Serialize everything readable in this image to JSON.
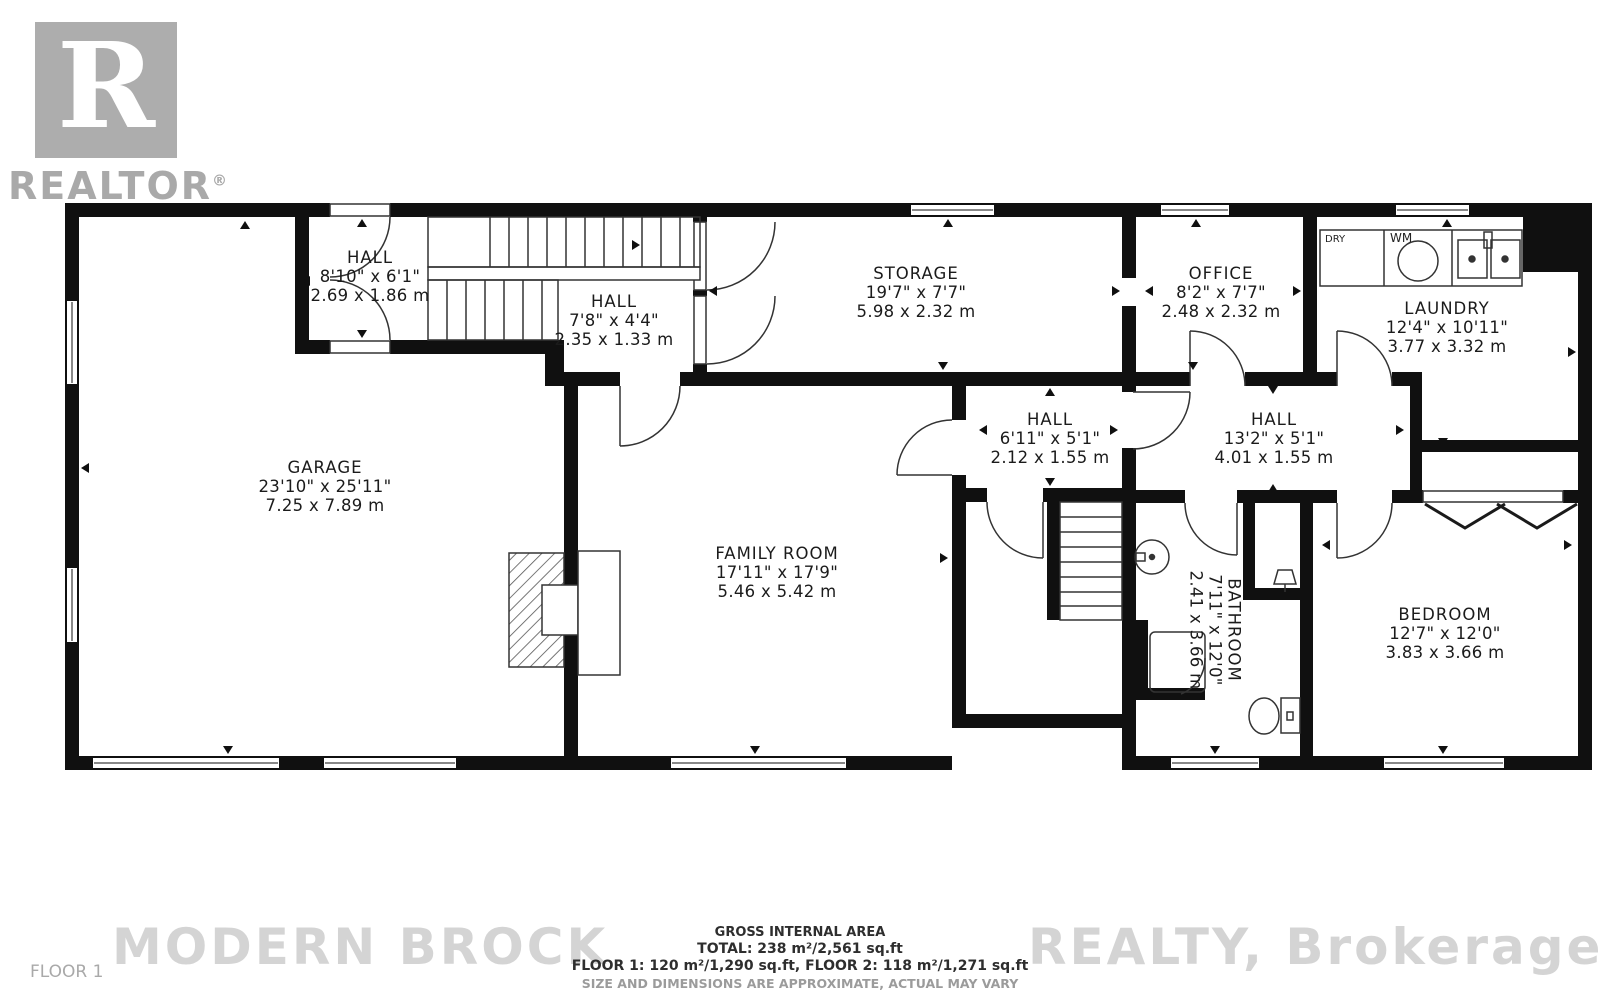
{
  "logo": {
    "letter": "R",
    "brand": "REALTOR",
    "registered": "®"
  },
  "floor_label": "FLOOR 1",
  "watermark": {
    "left": "MODERN BROCK",
    "right": "REALTY, Brokerage"
  },
  "footer": {
    "line1": "GROSS INTERNAL AREA",
    "line2": "TOTAL: 238 m²/2,561 sq.ft",
    "line3": "FLOOR 1: 120 m²/1,290 sq.ft, FLOOR 2: 118 m²/1,271 sq.ft",
    "line4": "SIZE AND DIMENSIONS ARE APPROXIMATE, ACTUAL MAY VARY"
  },
  "appliances": {
    "dryer": "DRY",
    "washer": "WM"
  },
  "rooms": [
    {
      "id": "hall-entry",
      "name": "HALL",
      "imperial": "8'10\" x 6'1\"",
      "metric": "2.69 x 1.86 m"
    },
    {
      "id": "hall-stairs",
      "name": "HALL",
      "imperial": "7'8\" x 4'4\"",
      "metric": "2.35 x 1.33 m"
    },
    {
      "id": "storage",
      "name": "STORAGE",
      "imperial": "19'7\" x 7'7\"",
      "metric": "5.98 x 2.32 m"
    },
    {
      "id": "office",
      "name": "OFFICE",
      "imperial": "8'2\" x 7'7\"",
      "metric": "2.48 x 2.32 m"
    },
    {
      "id": "laundry",
      "name": "LAUNDRY",
      "imperial": "12'4\" x 10'11\"",
      "metric": "3.77 x 3.32 m"
    },
    {
      "id": "garage",
      "name": "GARAGE",
      "imperial": "23'10\" x 25'11\"",
      "metric": "7.25 x 7.89 m"
    },
    {
      "id": "family-room",
      "name": "FAMILY ROOM",
      "imperial": "17'11\" x 17'9\"",
      "metric": "5.46 x 5.42 m"
    },
    {
      "id": "hall-middle",
      "name": "HALL",
      "imperial": "6'11\" x 5'1\"",
      "metric": "2.12 x 1.55 m"
    },
    {
      "id": "hall-upper",
      "name": "HALL",
      "imperial": "13'2\" x 5'1\"",
      "metric": "4.01 x 1.55 m"
    },
    {
      "id": "bathroom",
      "name": "BATHROOM",
      "imperial": "7'11\" x 12'0\"",
      "metric": "2.41 x 3.66 m"
    },
    {
      "id": "bedroom",
      "name": "BEDROOM",
      "imperial": "12'7\" x 12'0\"",
      "metric": "3.83 x 3.66 m"
    }
  ]
}
